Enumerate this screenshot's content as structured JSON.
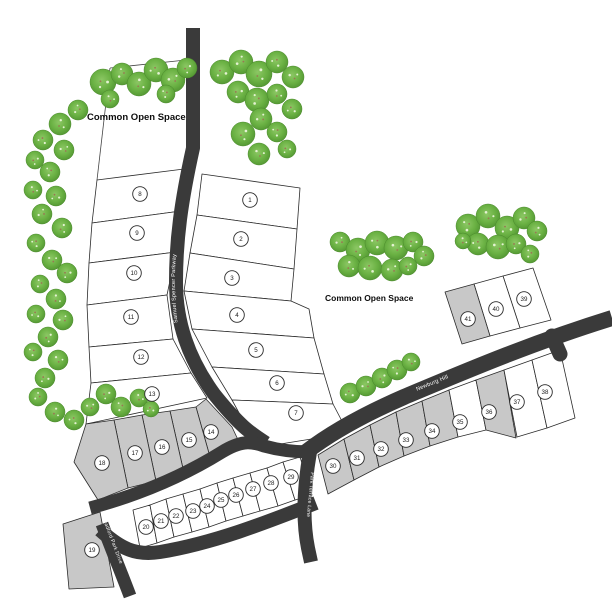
{
  "map": {
    "width": 612,
    "height": 612,
    "colors": {
      "background": "#ffffff",
      "road": "#3a3a3a",
      "lot_white": "#ffffff",
      "lot_gray": "#c8c8c8",
      "lot_stroke": "#2b2b2b",
      "boundary": "#444444",
      "road_label_text": "#ffffff",
      "tree_light": "#8cc764",
      "tree_mid": "#6ab143",
      "tree_dark": "#4f9230",
      "tree_edge": "#4a8a2b",
      "tree_speck": "#e4f2d2",
      "tree_branch": "#9b7653",
      "label_text": "#0d0d0d"
    },
    "open_space_labels": [
      {
        "text": "Common Open Space",
        "x": 87,
        "y": 120,
        "size": 9.5
      },
      {
        "text": "Common Open Space",
        "x": 325,
        "y": 301,
        "size": 8.5
      }
    ],
    "boundary_lines": [
      "110,68 97,180",
      "110,68 186,60"
    ],
    "roads": [
      {
        "name": "samuel-spencer-parkway",
        "d": "M 193,28 L 193,148 C 181,202 176,240 176,282 C 176,322 188,358 214,394 C 222,404 232,416 244,427 C 252,434 258,438 266,443",
        "width": 14
      },
      {
        "name": "upper-access-road",
        "d": "M 90,508 C 135,496 180,478 222,452 C 240,441 250,441 264,446 C 282,451 296,452 310,452",
        "width": 13
      },
      {
        "name": "newburg-hill",
        "d": "M 306,452 C 332,432 365,414 404,397 C 452,377 525,345 612,318",
        "width": 16
      },
      {
        "name": "newburg-stub",
        "d": "M 552,336 L 560,354",
        "width": 15,
        "cap": "round"
      },
      {
        "name": "park-terrace-lane",
        "d": "M 310,452 C 304,486 302,518 308,548 L 311,562",
        "width": 14
      },
      {
        "name": "lower-access-road",
        "d": "M 100,530 C 120,548 135,556 160,552 C 215,543 270,521 316,503",
        "width": 14
      },
      {
        "name": "bradford-park-drive",
        "d": "M 102,524 C 111,548 121,572 130,596",
        "width": 13
      }
    ],
    "road_labels": [
      {
        "text": "Samuel Spencer Parkway",
        "path": "M 179,334 C 174,300 173,262 180,220",
        "size": 5.5,
        "offset": "10%"
      },
      {
        "text": "Newburg Hill",
        "path": "M 407,395 L 490,361",
        "size": 5.5,
        "offset": "12%"
      },
      {
        "text": "Park Terrace Lane",
        "path": "M 312,462 L 304,548",
        "size": 5,
        "offset": "12%"
      },
      {
        "text": "Bradford Park Drive",
        "path": "M 100,512 L 132,596",
        "size": 5,
        "offset": "8%"
      }
    ],
    "lots": [
      {
        "number": "1",
        "shade": "white",
        "points": "202,174 300,188 297,229 197,215",
        "cx": 250,
        "cy": 200
      },
      {
        "number": "2",
        "shade": "white",
        "points": "197,215 297,229 294,269 190,253",
        "cx": 241,
        "cy": 239
      },
      {
        "number": "3",
        "shade": "white",
        "points": "190,253 294,269 291,301 184,291",
        "cx": 232,
        "cy": 278
      },
      {
        "number": "4",
        "shade": "white",
        "points": "184,291 291,301 309,309 314,338 192,329",
        "cx": 237,
        "cy": 315
      },
      {
        "number": "5",
        "shade": "white",
        "points": "192,329 314,338 324,374 212,367",
        "cx": 256,
        "cy": 350
      },
      {
        "number": "6",
        "shade": "white",
        "points": "212,367 324,374 333,404 232,400",
        "cx": 277,
        "cy": 383
      },
      {
        "number": "7",
        "shade": "white",
        "points": "232,400 333,404 344,425 330,436 268,446 244,422",
        "cx": 296,
        "cy": 413
      },
      {
        "number": "8",
        "shade": "white",
        "points": "97,180 184,169 181,211 92,223",
        "cx": 140,
        "cy": 194
      },
      {
        "number": "9",
        "shade": "white",
        "points": "92,223 181,211 176,252 89,263",
        "cx": 137,
        "cy": 233
      },
      {
        "number": "10",
        "shade": "white",
        "points": "89,263 176,252 167,295 87,305",
        "cx": 134,
        "cy": 273
      },
      {
        "number": "11",
        "shade": "white",
        "points": "87,305 167,295 173,339 89,347",
        "cx": 131,
        "cy": 317
      },
      {
        "number": "12",
        "shade": "white",
        "points": "89,347 173,339 191,373 91,383",
        "cx": 141,
        "cy": 357
      },
      {
        "number": "13",
        "shade": "white",
        "points": "91,383 191,373 207,398 86,424",
        "cx": 152,
        "cy": 394
      },
      {
        "number": "14",
        "shade": "gray",
        "points": "196,407 206,399 232,427 240,444 212,464",
        "cx": 211,
        "cy": 432
      },
      {
        "number": "15",
        "shade": "gray",
        "points": "170,411 196,407 212,464 184,473",
        "cx": 189,
        "cy": 440
      },
      {
        "number": "16",
        "shade": "gray",
        "points": "142,415 170,411 184,473 156,481",
        "cx": 162,
        "cy": 447
      },
      {
        "number": "17",
        "shade": "gray",
        "points": "114,420 142,415 156,481 128,488",
        "cx": 135,
        "cy": 453
      },
      {
        "number": "18",
        "shade": "gray",
        "points": "86,424 114,420 128,488 98,500 74,462",
        "cx": 102,
        "cy": 463
      },
      {
        "number": "19",
        "shade": "gray",
        "points": "63,524 100,512 114,587 69,589",
        "cx": 92,
        "cy": 550
      },
      {
        "number": "20",
        "shade": "white",
        "points": "133,510 150,505 157,543 140,548",
        "cx": 146,
        "cy": 527
      },
      {
        "number": "21",
        "shade": "white",
        "points": "150,505 166,499 174,537 157,543",
        "cx": 161,
        "cy": 521
      },
      {
        "number": "22",
        "shade": "white",
        "points": "166,499 183,494 192,532 174,537",
        "cx": 176,
        "cy": 516
      },
      {
        "number": "23",
        "shade": "white",
        "points": "183,494 200,489 209,527 192,532",
        "cx": 193,
        "cy": 511
      },
      {
        "number": "24",
        "shade": "white",
        "points": "200,489 217,483 226,521 209,527",
        "cx": 207,
        "cy": 506
      },
      {
        "number": "25",
        "shade": "white",
        "points": "217,483 233,478 243,516 226,521",
        "cx": 221,
        "cy": 500
      },
      {
        "number": "26",
        "shade": "white",
        "points": "233,478 250,473 260,511 243,516",
        "cx": 236,
        "cy": 495
      },
      {
        "number": "27",
        "shade": "white",
        "points": "250,473 267,468 278,506 260,511",
        "cx": 253,
        "cy": 489
      },
      {
        "number": "28",
        "shade": "white",
        "points": "267,468 283,462 295,500 278,506",
        "cx": 271,
        "cy": 483
      },
      {
        "number": "29",
        "shade": "white",
        "points": "283,462 300,457 312,495 295,500",
        "cx": 291,
        "cy": 477
      },
      {
        "number": "30",
        "shade": "gray",
        "points": "318,455 344,439 354,480 328,494",
        "cx": 333,
        "cy": 466
      },
      {
        "number": "31",
        "shade": "gray",
        "points": "344,439 370,425 379,467 354,480",
        "cx": 357,
        "cy": 458
      },
      {
        "number": "32",
        "shade": "gray",
        "points": "370,425 396,412 404,456 379,467",
        "cx": 381,
        "cy": 449
      },
      {
        "number": "33",
        "shade": "gray",
        "points": "396,412 422,401 430,446 404,456",
        "cx": 406,
        "cy": 440
      },
      {
        "number": "34",
        "shade": "gray",
        "points": "422,401 449,390 458,437 430,446",
        "cx": 432,
        "cy": 431
      },
      {
        "number": "35",
        "shade": "white",
        "points": "449,390 476,380 486,430 458,437",
        "cx": 460,
        "cy": 422
      },
      {
        "number": "36",
        "shade": "gray",
        "points": "476,380 504,370 516,438 486,430",
        "cx": 489,
        "cy": 412
      },
      {
        "number": "37",
        "shade": "white",
        "points": "504,370 532,360 547,428 517,437",
        "cx": 517,
        "cy": 402
      },
      {
        "number": "38",
        "shade": "white",
        "points": "532,360 560,350 575,418 547,428",
        "cx": 545,
        "cy": 392
      },
      {
        "number": "39",
        "shade": "white",
        "points": "503,276 533,268 551,320 520,328",
        "cx": 524,
        "cy": 299
      },
      {
        "number": "40",
        "shade": "white",
        "points": "474,284 503,276 520,328 490,336",
        "cx": 496,
        "cy": 309
      },
      {
        "number": "41",
        "shade": "gray",
        "points": "445,292 474,284 490,336 462,344",
        "cx": 468,
        "cy": 319
      }
    ],
    "trees": [
      [
        103,
        82,
        13
      ],
      [
        122,
        74,
        11
      ],
      [
        139,
        84,
        12
      ],
      [
        156,
        70,
        12
      ],
      [
        173,
        80,
        12
      ],
      [
        187,
        68,
        10
      ],
      [
        166,
        94,
        9
      ],
      [
        110,
        99,
        9
      ],
      [
        222,
        72,
        12
      ],
      [
        241,
        62,
        12
      ],
      [
        259,
        74,
        13
      ],
      [
        277,
        62,
        11
      ],
      [
        293,
        77,
        11
      ],
      [
        238,
        92,
        11
      ],
      [
        257,
        100,
        12
      ],
      [
        277,
        94,
        10
      ],
      [
        292,
        109,
        10
      ],
      [
        261,
        119,
        11
      ],
      [
        243,
        134,
        12
      ],
      [
        277,
        132,
        10
      ],
      [
        259,
        154,
        11
      ],
      [
        287,
        149,
        9
      ],
      [
        78,
        110,
        10
      ],
      [
        60,
        124,
        11
      ],
      [
        43,
        140,
        10
      ],
      [
        64,
        150,
        10
      ],
      [
        35,
        160,
        9
      ],
      [
        50,
        172,
        10
      ],
      [
        33,
        190,
        9
      ],
      [
        56,
        196,
        10
      ],
      [
        42,
        214,
        10
      ],
      [
        62,
        228,
        10
      ],
      [
        36,
        243,
        9
      ],
      [
        52,
        260,
        10
      ],
      [
        67,
        273,
        10
      ],
      [
        40,
        284,
        9
      ],
      [
        56,
        299,
        10
      ],
      [
        36,
        314,
        9
      ],
      [
        63,
        320,
        10
      ],
      [
        48,
        337,
        10
      ],
      [
        33,
        352,
        9
      ],
      [
        58,
        360,
        10
      ],
      [
        45,
        378,
        10
      ],
      [
        38,
        397,
        9
      ],
      [
        55,
        412,
        10
      ],
      [
        74,
        420,
        10
      ],
      [
        90,
        407,
        9
      ],
      [
        106,
        394,
        10
      ],
      [
        121,
        407,
        10
      ],
      [
        139,
        398,
        9
      ],
      [
        151,
        409,
        8
      ],
      [
        340,
        242,
        10
      ],
      [
        358,
        250,
        12
      ],
      [
        377,
        243,
        12
      ],
      [
        396,
        248,
        12
      ],
      [
        413,
        242,
        10
      ],
      [
        424,
        256,
        10
      ],
      [
        349,
        266,
        11
      ],
      [
        370,
        268,
        12
      ],
      [
        392,
        270,
        11
      ],
      [
        408,
        266,
        9
      ],
      [
        468,
        226,
        12
      ],
      [
        488,
        216,
        12
      ],
      [
        507,
        228,
        12
      ],
      [
        524,
        218,
        11
      ],
      [
        537,
        231,
        10
      ],
      [
        478,
        244,
        11
      ],
      [
        498,
        247,
        12
      ],
      [
        516,
        244,
        10
      ],
      [
        530,
        254,
        9
      ],
      [
        463,
        241,
        8
      ],
      [
        350,
        393,
        10
      ],
      [
        366,
        386,
        10
      ],
      [
        382,
        378,
        10
      ],
      [
        397,
        370,
        10
      ],
      [
        411,
        362,
        9
      ]
    ]
  }
}
